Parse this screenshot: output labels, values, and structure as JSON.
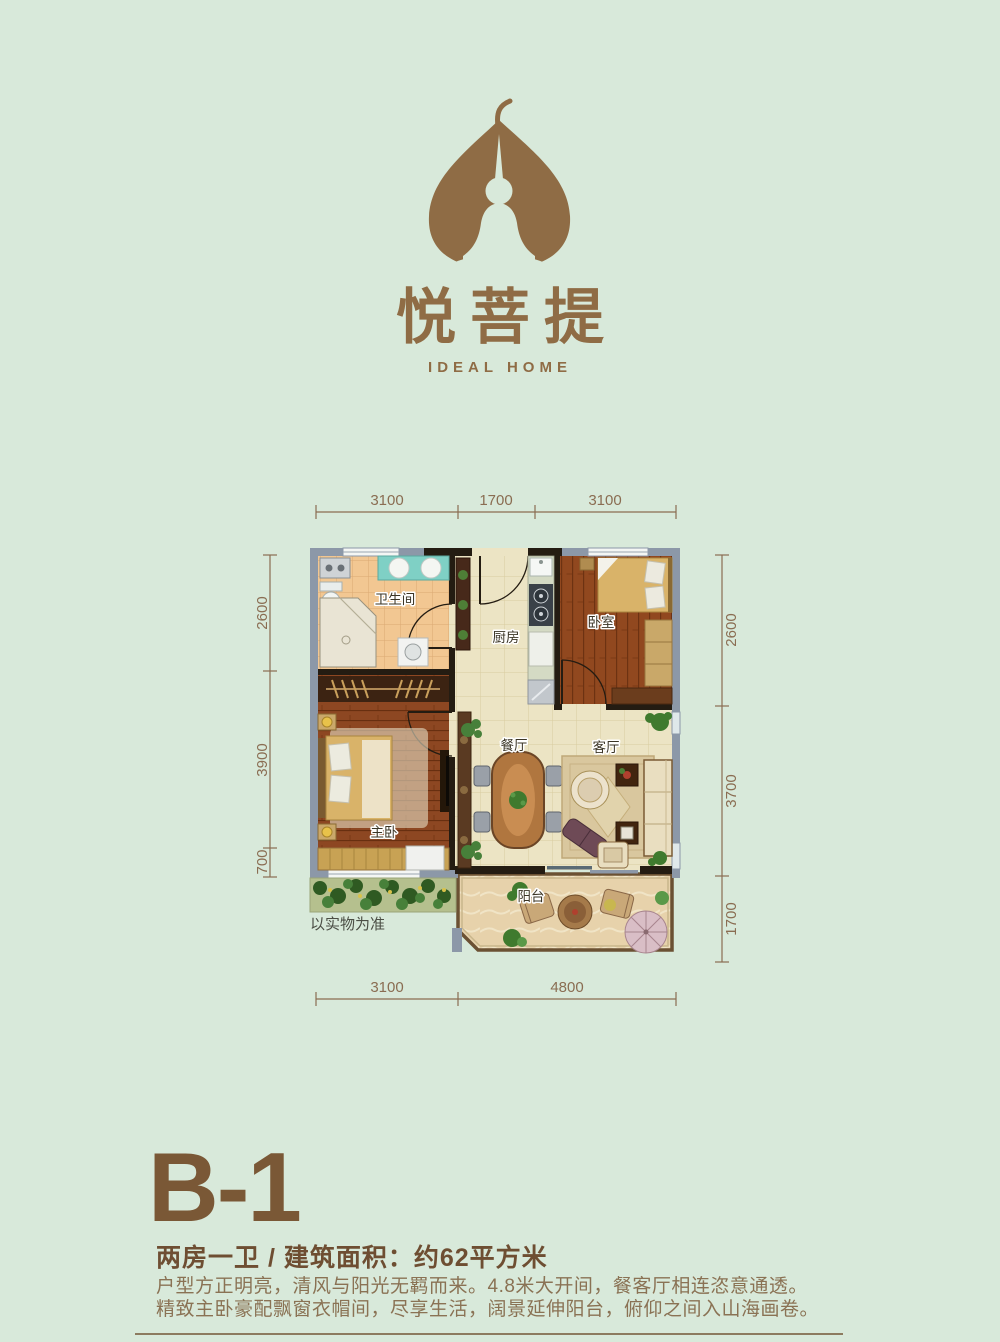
{
  "brand": {
    "name_cn": "悦菩提",
    "name_en": "IDEAL HOME"
  },
  "floor_plan": {
    "disclaimer": "以实物为准",
    "room_labels": {
      "bathroom": "卫生间",
      "kitchen": "厨房",
      "bedroom": "卧室",
      "master_bedroom": "主卧",
      "dining": "餐厅",
      "living": "客厅",
      "balcony": "阳台"
    },
    "dimensions": {
      "top": [
        "3100",
        "1700",
        "3100"
      ],
      "bottom": [
        "3100",
        "4800"
      ],
      "left": [
        "2600",
        "3900",
        "700"
      ],
      "right": [
        "2600",
        "3700",
        "1700"
      ]
    }
  },
  "unit_info": {
    "code": "B-1",
    "summary": "两房一卫 / 建筑面积：约62平方米",
    "description": [
      "户型方正明亮，清风与阳光无羁而来。4.8米大开间，餐客厅相连恣意通透。",
      "精致主卧豪配飘窗衣帽间，尽享生活，阔景延伸阳台，俯仰之间入山海画卷。"
    ]
  },
  "colors": {
    "background": "#d8e9da",
    "brand_brown": "#8f6c45",
    "title_brown": "#7a5836",
    "dimension_brown": "#8a6d52"
  }
}
